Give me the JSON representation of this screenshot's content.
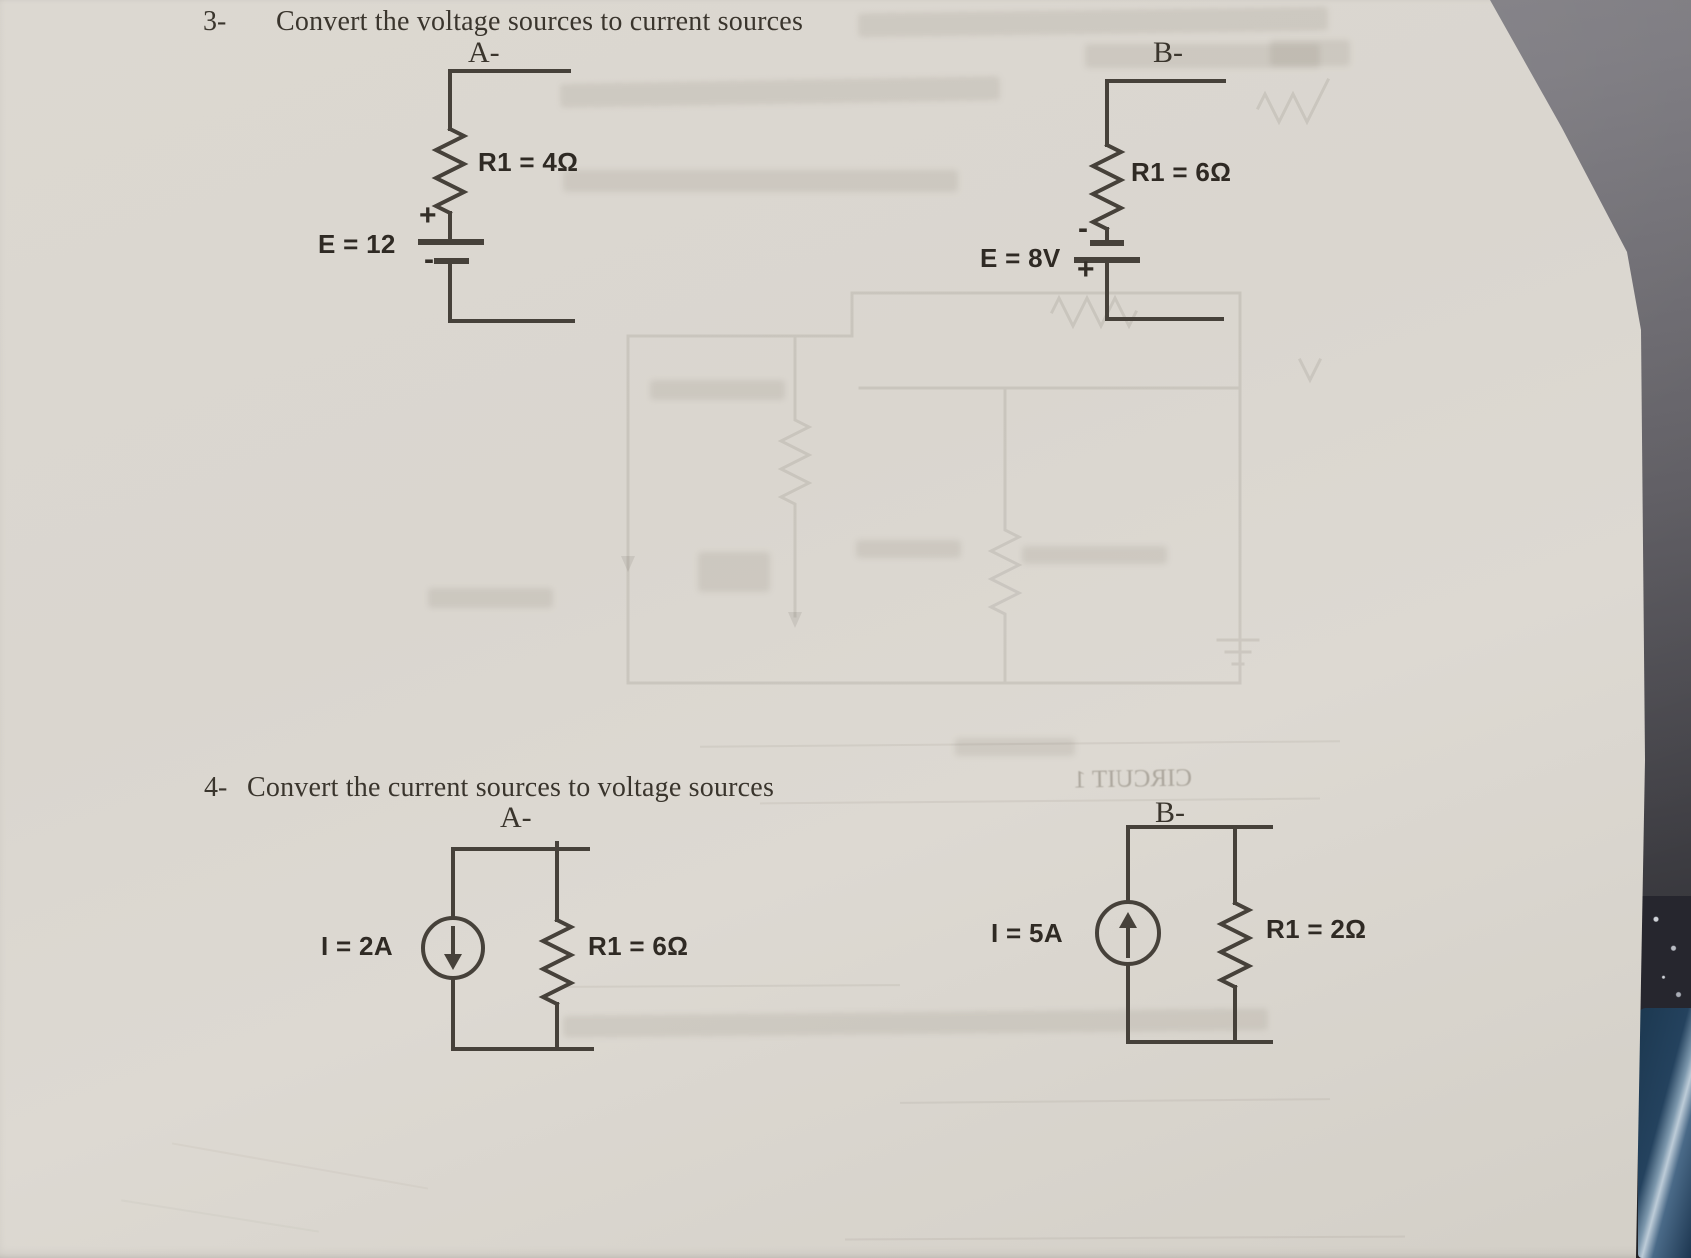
{
  "s3": {
    "number": "3-",
    "title": "Convert the voltage sources to current sources",
    "a": {
      "label": "A-",
      "resistor": "R1 = 4Ω",
      "source": "E = 12",
      "plus": "+",
      "minus": "-"
    },
    "b": {
      "label": "B-",
      "resistor": "R1 = 6Ω",
      "source": "E = 8V",
      "plus": "+",
      "minus": "-"
    }
  },
  "s4": {
    "number": "4-",
    "title": "Convert the current sources to voltage sources",
    "a": {
      "label": "A-",
      "source": "I = 2A",
      "resistor": "R1 = 6Ω"
    },
    "b": {
      "label": "B-",
      "source": "I = 5A",
      "resistor": "R1 = 2Ω"
    }
  },
  "bleedthrough": {
    "circuit_title": "CIRCUIT 1"
  },
  "colors": {
    "paper": "#d9d5cd",
    "ink": "#38332c",
    "wire": "#46413a",
    "desk": "#55535a",
    "pen": "#2e5377"
  }
}
